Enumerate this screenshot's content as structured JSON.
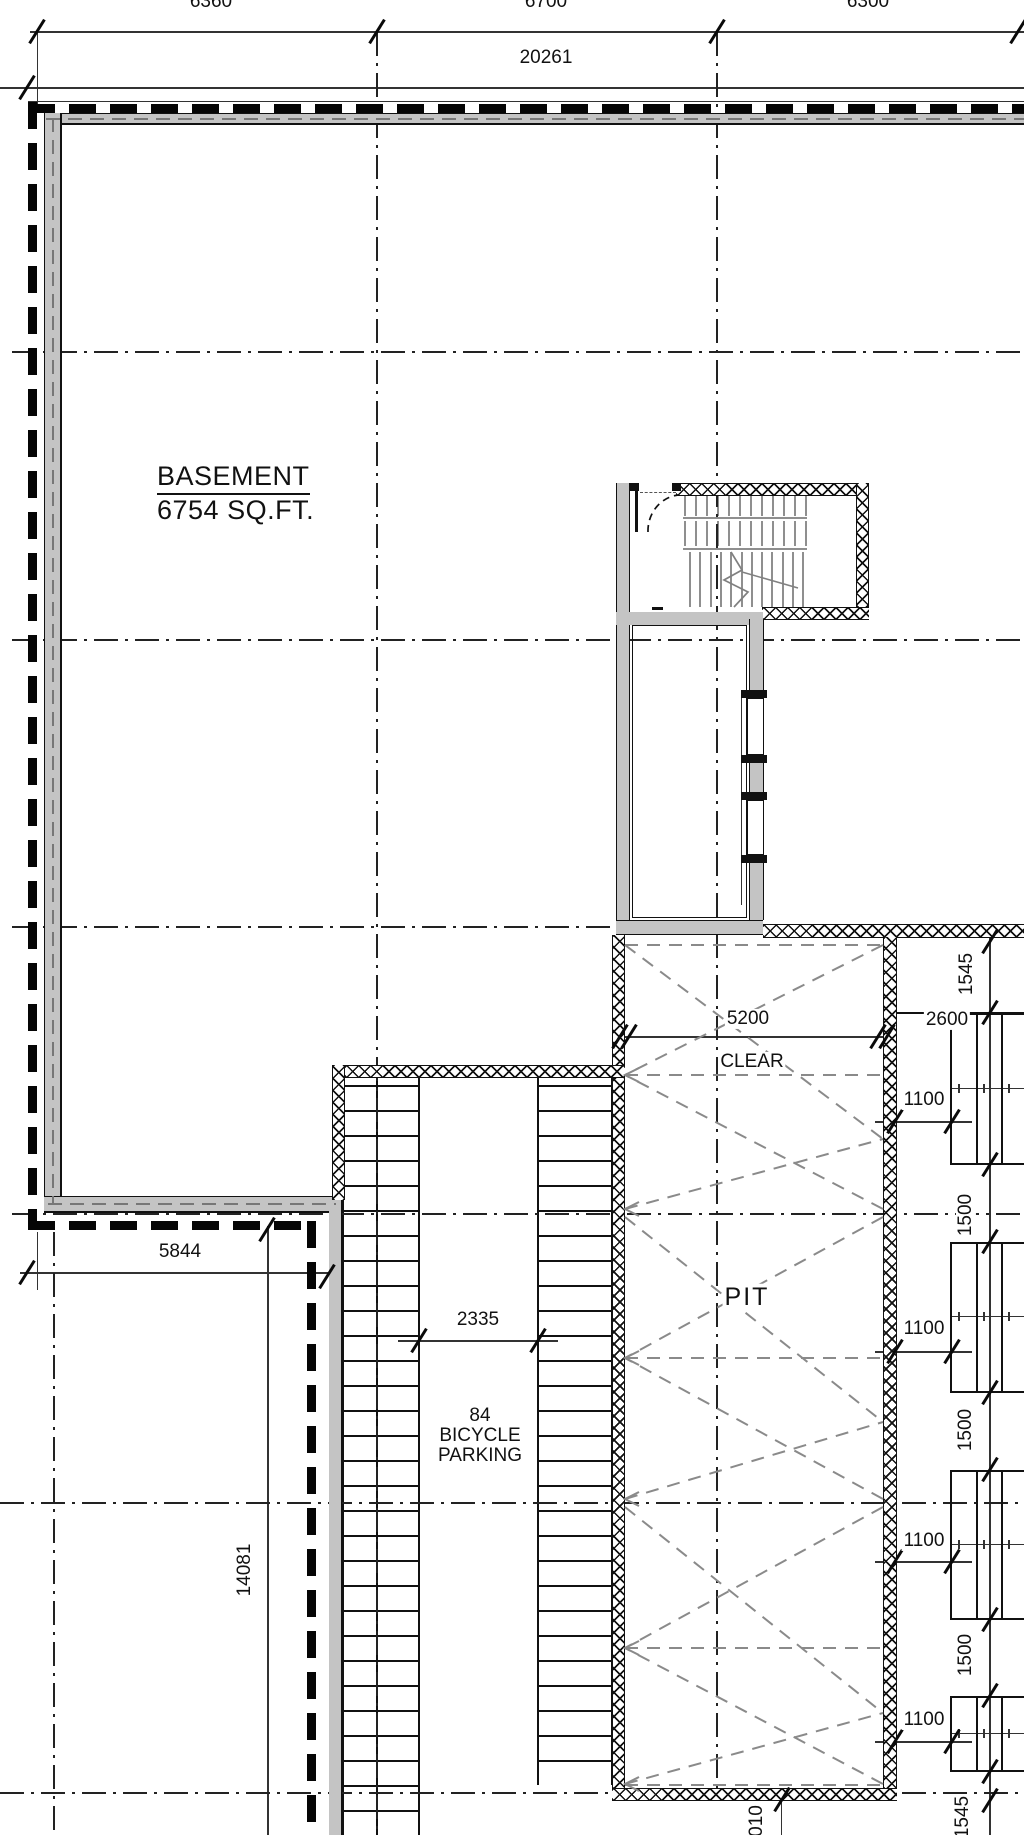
{
  "plan": {
    "room": {
      "title": "BASEMENT",
      "area": "6754 SQ.FT."
    },
    "pit": {
      "label": "PIT",
      "width": "5200",
      "clear": "CLEAR"
    },
    "bike": {
      "count": "84",
      "line2": "BICYCLE",
      "line3": "PARKING",
      "aisle": "2335"
    },
    "dims": {
      "top": [
        "6360",
        "6700",
        "6300"
      ],
      "overall": "20261",
      "left": "5844",
      "side": "14081",
      "right": {
        "t1545": "1545",
        "d2600": "2600",
        "g1100": [
          "1100",
          "1100",
          "1100",
          "1100"
        ],
        "s1500": [
          "1500",
          "1500",
          "1500"
        ],
        "b1545": "1545",
        "bottom_cut": "010"
      }
    },
    "colors": {
      "wall": "#c4c4c4",
      "line": "#111111",
      "dash": "#8a8a8a"
    }
  }
}
